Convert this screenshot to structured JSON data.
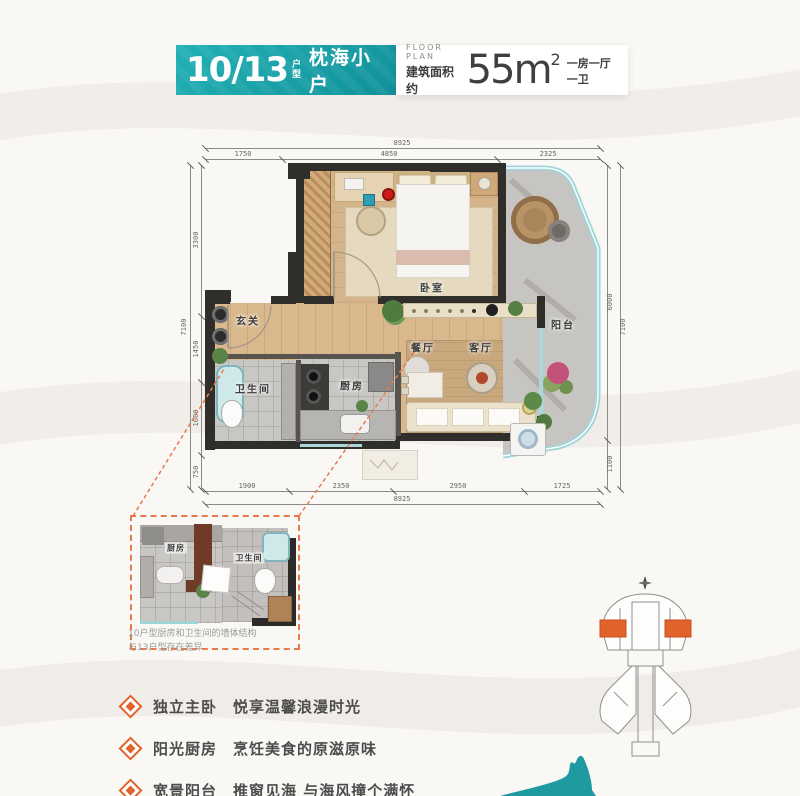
{
  "header": {
    "unit_number": "10/13",
    "unit_type": "户型",
    "unit_name": "枕海小户",
    "floor_plan_label": "FLOOR PLAN",
    "area_label": "建筑面积约",
    "area_number": "55",
    "area_unit": "m",
    "area_exponent": "2",
    "layout_summary": "一房一厅一卫"
  },
  "plan": {
    "rooms": {
      "entry": "玄关",
      "bedroom": "卧室",
      "dining": "餐厅",
      "living": "客厅",
      "kitchen": "厨房",
      "bathroom": "卫生间",
      "balcony": "阳台"
    },
    "dimensions": {
      "top": {
        "total": "8925",
        "segments": [
          "1750",
          "4850",
          "2325"
        ]
      },
      "bottom": {
        "total": "8925",
        "segments": [
          "1900",
          "2350",
          "2950",
          "1725"
        ]
      },
      "left": {
        "total": "7100",
        "segments": [
          "3300",
          "1450",
          "1600",
          "750"
        ]
      },
      "right": {
        "total": "7100",
        "segments": [
          "6000",
          "1100"
        ]
      }
    }
  },
  "inset": {
    "kitchen_label": "厨房",
    "bathroom_label": "卫生间",
    "note_line1": "10户型厨房和卫生间的墙体结构",
    "note_line2": "与13户型存在差异"
  },
  "features": [
    {
      "title": "独立主卧",
      "desc": "悦享温馨浪漫时光"
    },
    {
      "title": "阳光厨房",
      "desc": "烹饪美食的原滋原味"
    },
    {
      "title": "宽景阳台",
      "desc": "推窗见海 与海风撞个满怀"
    }
  ],
  "colors": {
    "teal": "#17a2a8",
    "orange": "#e2622b"
  }
}
